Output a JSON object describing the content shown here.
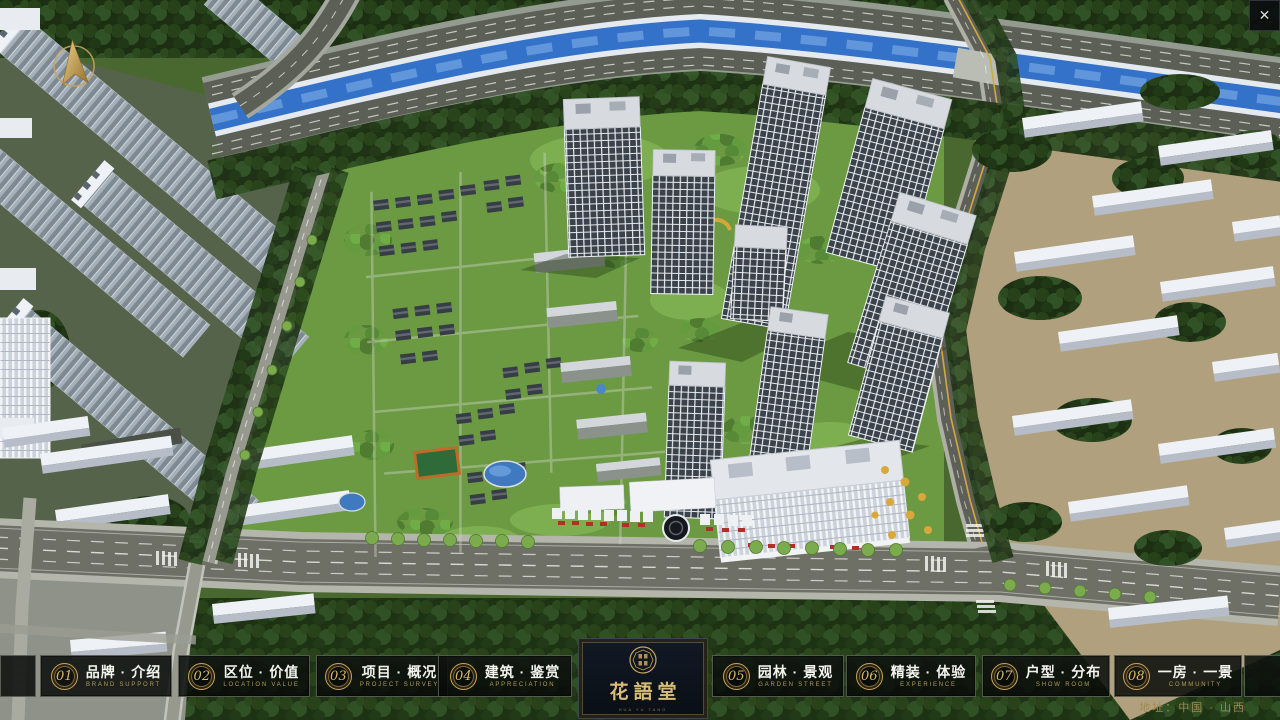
{
  "window": {
    "close_glyph": "✕"
  },
  "nav": {
    "items": [
      {
        "num": "01",
        "zh": "品牌 · 介绍",
        "en": "BRAND SUPPORT"
      },
      {
        "num": "02",
        "zh": "区位 · 价值",
        "en": "LOCATION VALUE"
      },
      {
        "num": "03",
        "zh": "项目 · 概况",
        "en": "PROJECT SURVEY"
      },
      {
        "num": "04",
        "zh": "建筑 · 鉴赏",
        "en": "APPRECIATION"
      },
      {
        "num": "05",
        "zh": "园林 · 景观",
        "en": "GARDEN STREET"
      },
      {
        "num": "06",
        "zh": "精装 · 体验",
        "en": "EXPERIENCE"
      },
      {
        "num": "07",
        "zh": "户型 · 分布",
        "en": "SHOW ROOM"
      },
      {
        "num": "08",
        "zh": "一房 · 一景",
        "en": "COMMUNITY"
      }
    ]
  },
  "logo": {
    "title": "花語堂",
    "tagline": "HUA YU TANG"
  },
  "footer": {
    "address": "地址：中国 · 山西"
  },
  "colors": {
    "gold": "#c9a45a",
    "bar_bg": "#0a0e0b",
    "river": "#3372c8"
  }
}
